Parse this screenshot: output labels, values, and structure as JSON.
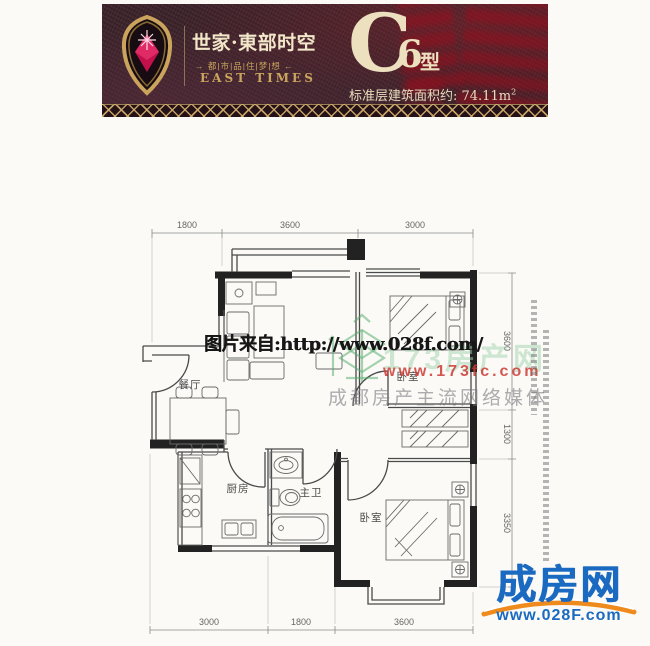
{
  "banner": {
    "brand": "世家·東部时空",
    "brand_sub": "→ 都|市|品|住|梦|想 ←",
    "brand_en": "EAST TIMES",
    "unit_c": "C",
    "unit_6": "6",
    "unit_type": "型",
    "area_text": "标准层建筑面积约: 74.11m",
    "area_exp": "2"
  },
  "plan": {
    "labels": {
      "dining": "餐厅",
      "kitchen": "厨房",
      "bath": "主卫",
      "bedroom_top": "卧室",
      "bedroom_bottom": "卧室"
    },
    "dims": {
      "top": [
        "1800",
        "3600",
        "3000"
      ],
      "bottom": [
        "3000",
        "1800",
        "3600"
      ],
      "right": [
        "3600",
        "1300",
        "3350"
      ]
    }
  },
  "watermarks": {
    "source": "图片来自:http://www.028f.com/",
    "ghost_brand": "173房产网",
    "ghost_url": "www.173fc.com",
    "slogan": "成都房产主流网络媒体",
    "footer_brand": "成房网",
    "footer_url": "www.028F.com"
  },
  "colors": {
    "banner_bg": "#40262e",
    "gold": "#c9a45c",
    "cream": "#efe3c4",
    "logo_blue": "#1a6ac1",
    "logo_orange": "#ef8a1c",
    "wm_red": "#cd3a34",
    "wm_green": "#58a36b"
  }
}
